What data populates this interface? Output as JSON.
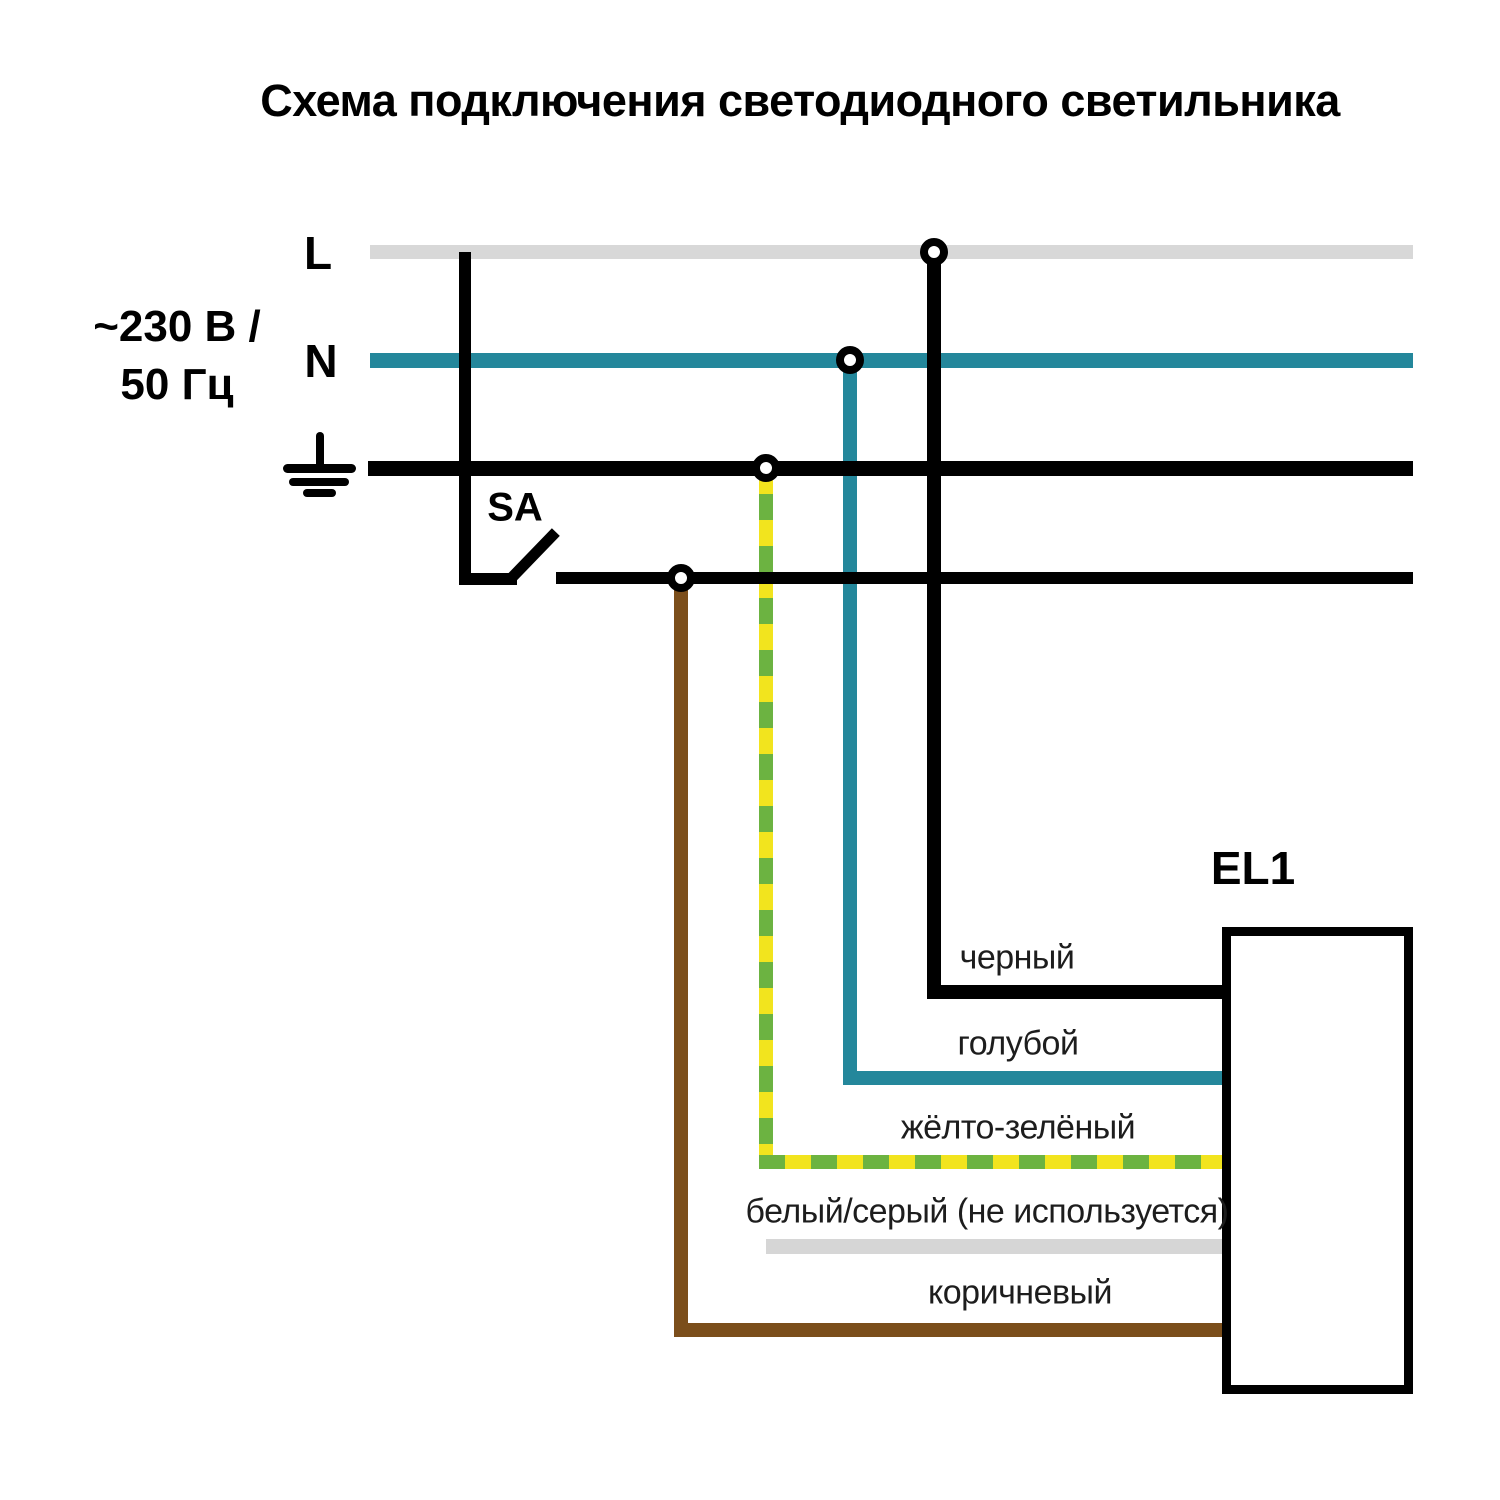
{
  "title": "Схема подключения светодиодного светильника",
  "power_source": {
    "voltage_line1": "~230 В /",
    "voltage_line2": "50 Гц",
    "phase_label": "L",
    "neutral_label": "N"
  },
  "switch_label": "SA",
  "luminaire_label": "EL1",
  "wire_labels": {
    "black": "черный",
    "blue": "голубой",
    "yellow_green": "жёлто-зелёный",
    "white_gray": "белый/серый (не используется)",
    "brown": "коричневый"
  },
  "colors": {
    "phase-gray": "#d8d8d8",
    "neutral-teal": "#24879b",
    "wire-black": "#000000",
    "wire-yellow": "#f2e41e",
    "wire-green": "#6cb341",
    "wire-brown": "#7b4e1b",
    "unused-gray": "#d6d6d6",
    "label-text": "#1d1d1d"
  }
}
